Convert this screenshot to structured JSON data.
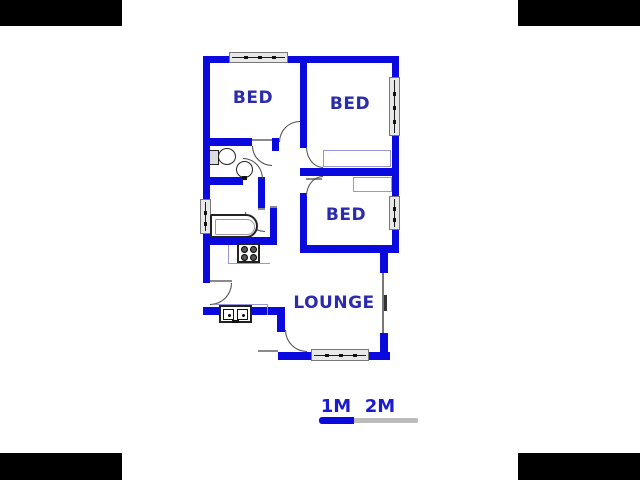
{
  "floorplan": {
    "rooms": {
      "bed1": {
        "label": "BED"
      },
      "bed2": {
        "label": "BED"
      },
      "bed3": {
        "label": "BED"
      },
      "lounge": {
        "label": "LOUNGE"
      }
    },
    "fixtures": [
      "toilet",
      "round-basin",
      "bathtub",
      "stove",
      "double-kitchen-sink"
    ],
    "windows": [
      {
        "location": "bed1-top-wall",
        "orientation": "horizontal"
      },
      {
        "location": "bed2-right-wall",
        "orientation": "vertical"
      },
      {
        "location": "bed3-right-wall",
        "orientation": "vertical"
      },
      {
        "location": "bathroom-left-wall",
        "orientation": "vertical"
      },
      {
        "location": "lounge-bottom-wall",
        "orientation": "horizontal"
      },
      {
        "location": "lounge-right-wall",
        "orientation": "glazed-opening"
      }
    ],
    "colors": {
      "wall": "#0a0ade",
      "room_label": "#2b2bad",
      "window_frame": "#777777",
      "window_fill": "#e8e8e8",
      "closet_outline": "#9898d8",
      "door_arc": "#4a4a4a",
      "fixture_outline": "#222222"
    }
  },
  "scale_bar": {
    "labels": {
      "one": "1M",
      "two": "2M"
    },
    "text_color": "#1b1bd0",
    "segments": [
      {
        "to": "1M",
        "color": "#0a0ade"
      },
      {
        "to": "2M",
        "color": "#bbbbbb"
      }
    ]
  }
}
